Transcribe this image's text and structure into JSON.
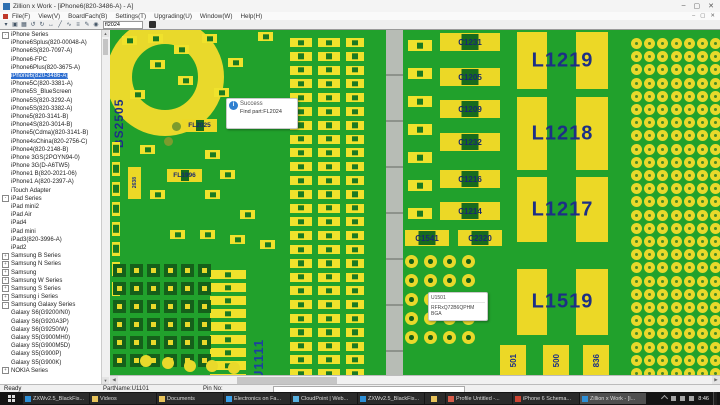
{
  "titlebar": {
    "title": "Zillion x Work - [iPhone6(820-3486-A) - A]",
    "minimize": "–",
    "restore": "▢",
    "close": "✕",
    "child_minimize": "–",
    "child_restore": "▢",
    "child_close": "✕"
  },
  "menubar": {
    "items": [
      "File(F)",
      "View(V)",
      "BoardFach(B)",
      "Settings(T)",
      "Upgrading(U)",
      "Window(W)",
      "Help(H)"
    ]
  },
  "toolbar": {
    "icons": [
      {
        "name": "select-arrow-icon",
        "glyph": "▾"
      },
      {
        "name": "board-top-layer-icon",
        "glyph": "▣"
      },
      {
        "name": "board-bottom-layer-icon",
        "glyph": "▦"
      },
      {
        "name": "rotate-left-icon",
        "glyph": "↺"
      },
      {
        "name": "rotate-right-icon",
        "glyph": "↻"
      },
      {
        "name": "move-hand-icon",
        "glyph": "↔"
      },
      {
        "name": "measure-icon",
        "glyph": "╱"
      },
      {
        "name": "trace-icon",
        "glyph": "∿"
      },
      {
        "name": "layers-icon",
        "glyph": "≡"
      },
      {
        "name": "annotate-icon",
        "glyph": "✎"
      },
      {
        "name": "zoom-icon",
        "glyph": "◉"
      }
    ],
    "search_value": "fl2024"
  },
  "sidebar": {
    "items": [
      {
        "label": "iPhone Series",
        "level": 0,
        "expand": "-"
      },
      {
        "label": "iPhone6Splus(820-00048-A)",
        "level": 1
      },
      {
        "label": "iPhone6S(820-7097-A)",
        "level": 1
      },
      {
        "label": "iPhone6-FPC",
        "level": 1
      },
      {
        "label": "iPhone6Plus(820-3675-A)",
        "level": 1
      },
      {
        "label": "iPhone6(820-3486-A)",
        "level": 1,
        "selected": true
      },
      {
        "label": "iPhone5C(820-3381-A)",
        "level": 1
      },
      {
        "label": "iPhone5S_BlueScreen",
        "level": 1
      },
      {
        "label": "iPhone5S(820-3292-A)",
        "level": 1
      },
      {
        "label": "iPhone5S(820-3382-A)",
        "level": 1
      },
      {
        "label": "iPhone5(820-3141-B)",
        "level": 1
      },
      {
        "label": "iPhone4S(820-3014-B)",
        "level": 1
      },
      {
        "label": "iPhone5(Cdma)(820-3141-B)",
        "level": 1
      },
      {
        "label": "iPhone4sChina(820-2756-C)",
        "level": 1
      },
      {
        "label": "iPhone4(820-2148-B)",
        "level": 1
      },
      {
        "label": "iPhone 3GS(2POYN94-0)",
        "level": 1
      },
      {
        "label": "iPhone 3G(D-A6TW5)",
        "level": 1
      },
      {
        "label": "iPhone1 B(820-2021-06)",
        "level": 1
      },
      {
        "label": "iPhone1 A(820-2397-A)",
        "level": 1
      },
      {
        "label": "iTouch Adapter",
        "level": 1
      },
      {
        "label": "iPad Series",
        "level": 0,
        "expand": "-"
      },
      {
        "label": "iPad mini2",
        "level": 1
      },
      {
        "label": "iPad Air",
        "level": 1
      },
      {
        "label": "iPad4",
        "level": 1
      },
      {
        "label": "iPad mini",
        "level": 1
      },
      {
        "label": "iPad3(820-3996-A)",
        "level": 1
      },
      {
        "label": "iPad2",
        "level": 1
      },
      {
        "label": "Samsung B Series",
        "level": 0,
        "expand": "+"
      },
      {
        "label": "Samsung N Series",
        "level": 0,
        "expand": "+"
      },
      {
        "label": "Samsung",
        "level": 0,
        "expand": "+"
      },
      {
        "label": "Samsung W Series",
        "level": 0,
        "expand": "+"
      },
      {
        "label": "Samsung S Series",
        "level": 0,
        "expand": "+"
      },
      {
        "label": "Samsung i Series",
        "level": 0,
        "expand": "+"
      },
      {
        "label": "Samsung Galaxy Series",
        "level": 0,
        "expand": "-"
      },
      {
        "label": "Galaxy S6(G9200/N0)",
        "level": 1
      },
      {
        "label": "Galaxy S6(G920A3P)",
        "level": 1
      },
      {
        "label": "Galaxy S6(G9250/W)",
        "level": 1
      },
      {
        "label": "Galaxy S5(G900MH0)",
        "level": 1
      },
      {
        "label": "Galaxy S5(G900M5D)",
        "level": 1
      },
      {
        "label": "Galaxy S5(G900P)",
        "level": 1
      },
      {
        "label": "Galaxy S5(G900K)",
        "level": 1
      },
      {
        "label": "NOKIA Series",
        "level": 0,
        "expand": "+"
      }
    ]
  },
  "canvas": {
    "success_tip": {
      "title": "Success",
      "body": "Find part:FL2024"
    },
    "part_tip": {
      "l1": "U1501",
      "l2": "RFRxQ72B6QPHM",
      "l3": "BGA"
    },
    "bs_label": "BS2505",
    "u_label": "U1111",
    "donut": {
      "x": -4,
      "y": -12,
      "hole": 66,
      "ring": 26
    },
    "strip": {
      "x": 276,
      "y": 0,
      "w": 17,
      "h": 346
    },
    "caps": [
      {
        "x": 330,
        "y": 3,
        "label": "C1231"
      },
      {
        "x": 330,
        "y": 38,
        "label": "C1205"
      },
      {
        "x": 330,
        "y": 70,
        "label": "C1209"
      },
      {
        "x": 330,
        "y": 103,
        "label": "C1232"
      },
      {
        "x": 330,
        "y": 140,
        "label": "C1216"
      },
      {
        "x": 330,
        "y": 172,
        "label": "C1214"
      },
      {
        "x": 295,
        "y": 200,
        "w": 44,
        "h": 16,
        "label": "C1541"
      },
      {
        "x": 348,
        "y": 200,
        "w": 44,
        "h": 16,
        "label": "C2320"
      }
    ],
    "inductors": [
      {
        "x": 407,
        "y": 2,
        "w": 91,
        "h": 57,
        "label": "L1219"
      },
      {
        "x": 407,
        "y": 67,
        "w": 91,
        "h": 73,
        "label": "L1218"
      },
      {
        "x": 407,
        "y": 147,
        "w": 91,
        "h": 65,
        "label": "L1217"
      },
      {
        "x": 407,
        "y": 239,
        "w": 91,
        "h": 66,
        "label": "L1519"
      }
    ],
    "vcaps": [
      {
        "x": 390,
        "y": 315,
        "label": "501"
      },
      {
        "x": 433,
        "y": 315,
        "label": "500"
      },
      {
        "x": 473,
        "y": 315,
        "label": "836"
      }
    ],
    "fls": [
      {
        "x": 72,
        "y": 89,
        "label": "FL2025"
      },
      {
        "x": 57,
        "y": 139,
        "label": "FL1996"
      }
    ],
    "v2638": {
      "x": 18,
      "y": 137,
      "w": 13,
      "h": 32,
      "label": "2638"
    },
    "padcols": [
      {
        "x": 100,
        "y0": 240,
        "rows": 9,
        "step": 13,
        "w": 36,
        "h": 9
      },
      {
        "x": 180,
        "y0": 8,
        "rows": 25,
        "step": 13.8,
        "w": 22,
        "h": 9
      },
      {
        "x": 208,
        "y0": 8,
        "rows": 25,
        "step": 13.8,
        "w": 22,
        "h": 9
      },
      {
        "x": 236,
        "y0": 8,
        "rows": 25,
        "step": 13.8,
        "w": 18,
        "h": 9
      },
      {
        "x": 298,
        "y0": 10,
        "rows": 7,
        "step": 28,
        "w": 24,
        "h": 11
      },
      {
        "x": 2,
        "y0": 112,
        "rows": 8,
        "step": 20,
        "w": 8,
        "h": 14
      }
    ],
    "scatter": [
      [
        38,
        4
      ],
      [
        64,
        15
      ],
      [
        92,
        4
      ],
      [
        118,
        28
      ],
      [
        12,
        6
      ],
      [
        148,
        2
      ],
      [
        40,
        30
      ],
      [
        68,
        46
      ],
      [
        20,
        60
      ],
      [
        104,
        58
      ],
      [
        95,
        120
      ],
      [
        110,
        140
      ],
      [
        95,
        160
      ],
      [
        40,
        160
      ],
      [
        130,
        180
      ],
      [
        60,
        200
      ],
      [
        90,
        200
      ],
      [
        120,
        205
      ],
      [
        150,
        210
      ],
      [
        30,
        115
      ]
    ],
    "greensq": {
      "x0": 3,
      "y0": 234,
      "cols": 6,
      "rows": 6,
      "sx": 17,
      "sy": 18,
      "size": 13
    },
    "bga": {
      "x0": 295,
      "y0": 225,
      "cols": 4,
      "rows": 5,
      "step": 19,
      "d": 13
    },
    "rdots": {
      "x0": 521,
      "y0": 8,
      "cols": 7,
      "rows": 26,
      "step": 13.2,
      "d": 11
    },
    "ydots": [
      [
        30,
        325
      ],
      [
        52,
        327
      ],
      [
        74,
        330
      ],
      [
        96,
        330
      ],
      [
        118,
        332
      ]
    ],
    "gdots": [
      [
        62,
        92
      ],
      [
        54,
        107
      ]
    ]
  },
  "statusbar": {
    "ready": "Ready",
    "part": "PartName:U1101",
    "pin": "Pin No:"
  },
  "taskbar": {
    "items": [
      {
        "name": "taskbar-zxw-setup",
        "label": "ZXWv2.5_BlackFis...",
        "color": "#2e8fd6"
      },
      {
        "name": "taskbar-videos",
        "label": "Videos",
        "color": "#e8c35a"
      },
      {
        "name": "taskbar-documents",
        "label": "Documents",
        "color": "#e8c35a"
      },
      {
        "name": "taskbar-electronics",
        "label": "Electronics on Fa...",
        "color": "#3aa0e8"
      },
      {
        "name": "taskbar-cloudpoint",
        "label": "CloudPoint | Web...",
        "color": "#58b0e0"
      },
      {
        "name": "taskbar-zxw-setup-2",
        "label": "ZXWv2.5_BlackFis...",
        "color": "#2e8fd6"
      },
      {
        "name": "taskbar-folder",
        "label": "",
        "color": "#e8c35a",
        "icon_only": true
      },
      {
        "name": "taskbar-profile-untitled",
        "label": "Profile Untitled -...",
        "color": "#d85c4a"
      },
      {
        "name": "taskbar-iphone-schematic",
        "label": "iPhone 6 Schema...",
        "color": "#cc4433"
      },
      {
        "name": "taskbar-zillion-active",
        "label": "Zillion x Work - [i...",
        "color": "#2e8fd6",
        "active": true
      }
    ],
    "clock": "8:46"
  }
}
